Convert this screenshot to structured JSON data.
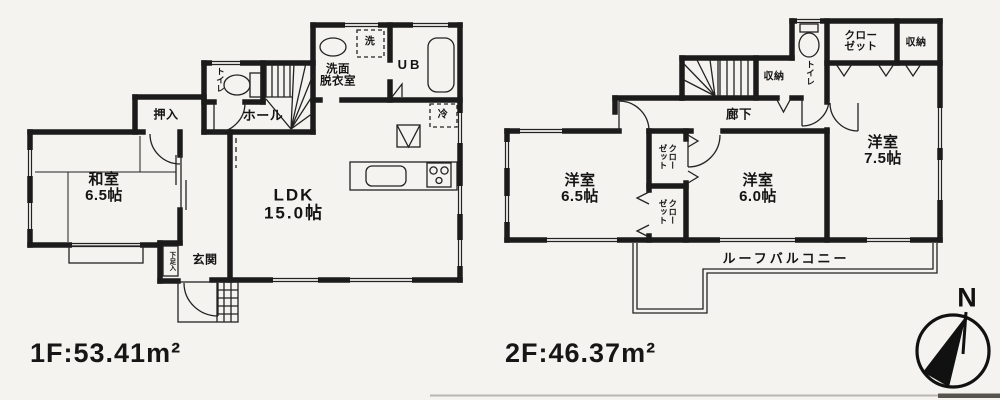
{
  "floor1": {
    "area_label": "1F:53.41m²",
    "rooms": {
      "washitsu": "和室\n6.5帖",
      "ldk": "LDK\n15.0帖",
      "hall": "ホール",
      "oshiire": "押入",
      "genkan": "玄関",
      "toilet": "トイレ",
      "washroom": "洗面\n脱衣室",
      "unit_bath": "UB",
      "washer": "洗",
      "fridge": "冷",
      "shoe_cabinet": "下足入"
    }
  },
  "floor2": {
    "area_label": "2F:46.37m²",
    "rooms": {
      "bedroom_65": "洋室\n6.5帖",
      "bedroom_60": "洋室\n6.0帖",
      "bedroom_75": "洋室\n7.5帖",
      "hallway": "廊下",
      "closet_top": "クロー\nゼット",
      "closet_mid_upper": "クロー\nゼット",
      "closet_mid_lower": "クロー\nゼット",
      "storage_by_stairs": "収納",
      "storage_top_right": "収納",
      "toilet": "トイレ",
      "roof_balcony": "ルーフバルコニー"
    }
  },
  "compass": {
    "north_label": "N"
  },
  "colors": {
    "wall": "#1b1b1b",
    "line": "#222222",
    "background": "#f4f3ef"
  }
}
